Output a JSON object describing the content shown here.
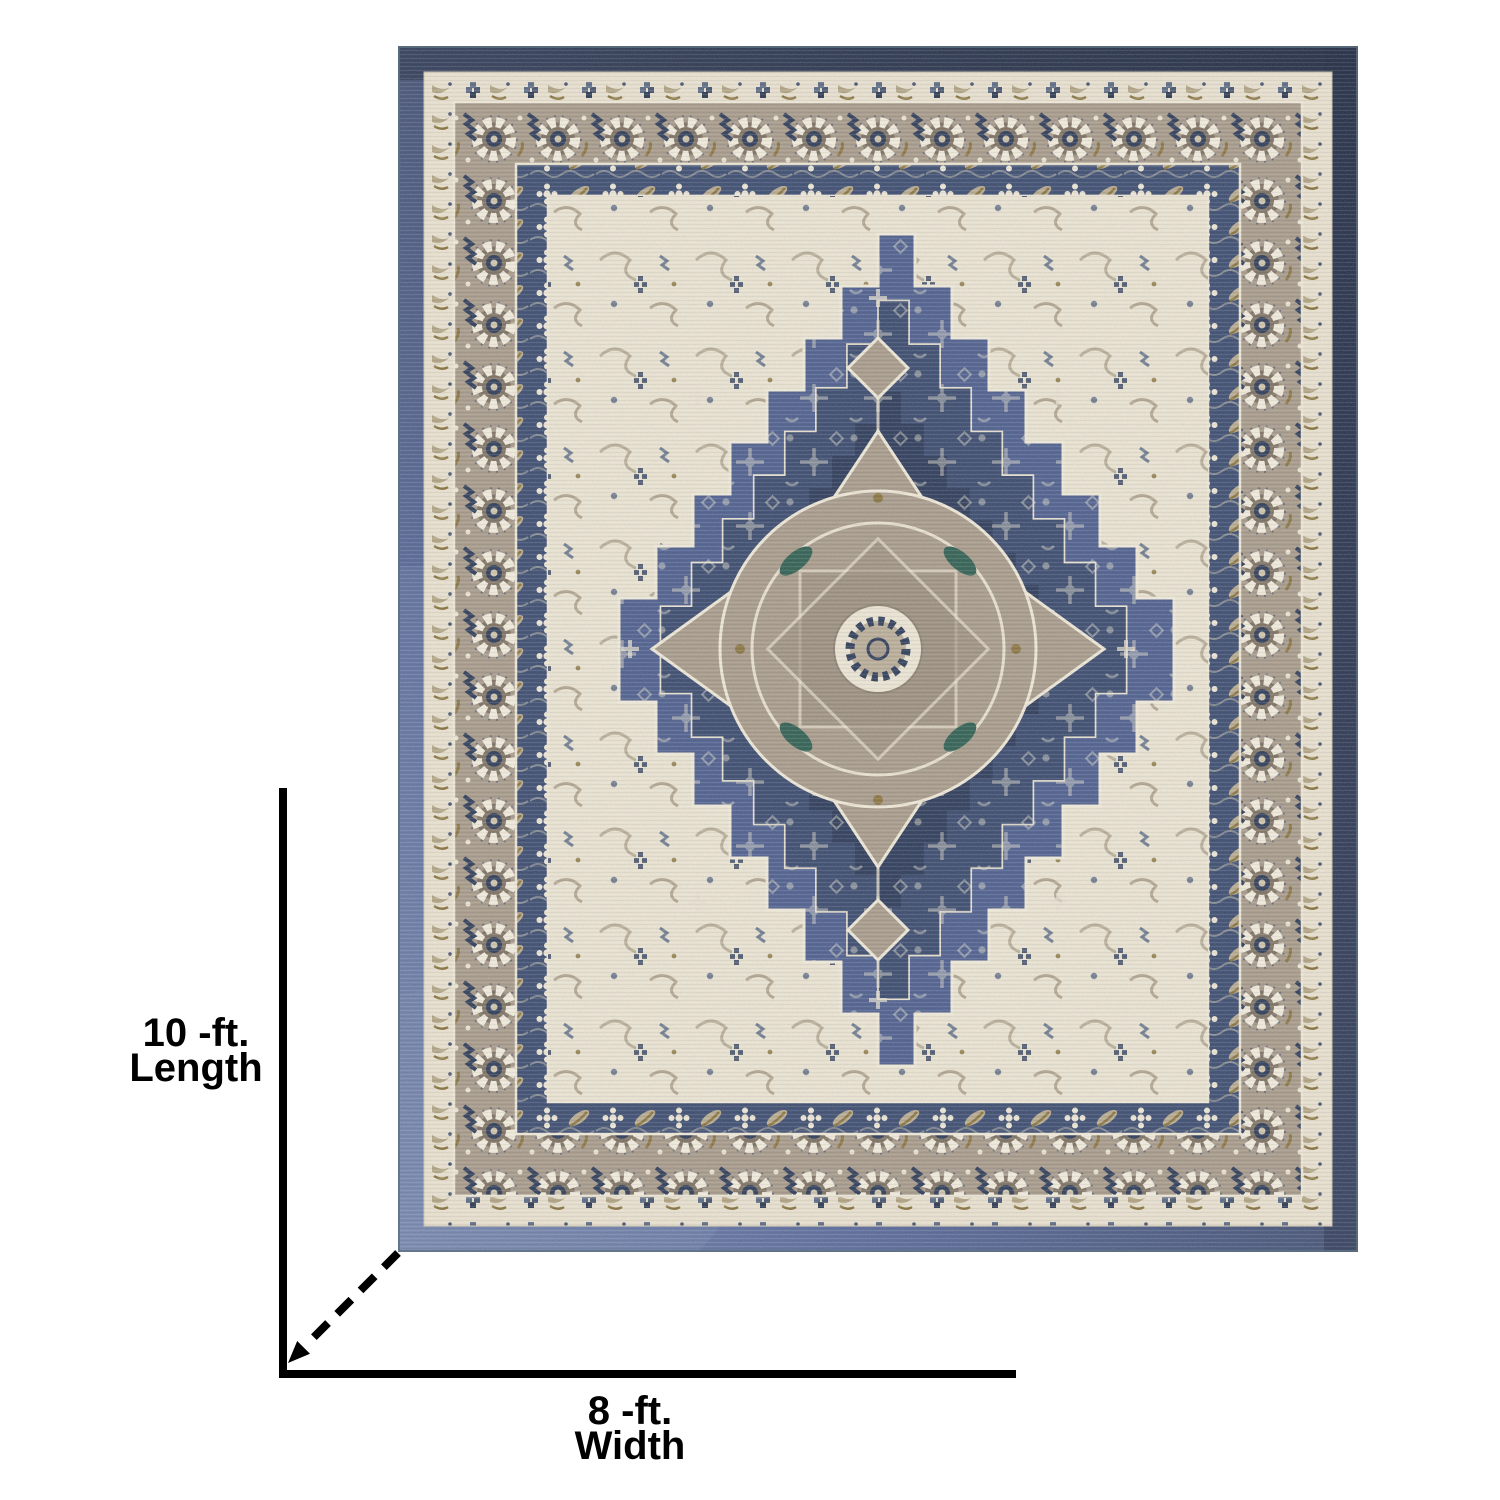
{
  "page": {
    "background_color": "#ffffff"
  },
  "diagram": {
    "subject": "vintage-medallion-area-rug",
    "length_dimension": {
      "value_line": "10 -ft.",
      "name_line": "Length"
    },
    "width_dimension": {
      "value_line": "8 -ft.",
      "name_line": "Width"
    },
    "palette": {
      "page_background": "#ffffff",
      "annotation": "#000000",
      "rug_navy_dark": "#27314a",
      "rug_denim": "#55669b",
      "rug_field_blue": "#4e5f8e",
      "rug_navy_medallion": "#2d3b5a",
      "rug_ivory": "#ebe4d2",
      "rug_taupe": "#a79a89",
      "rug_olive_gold": "#8a7540",
      "rug_teal": "#2f5f51"
    }
  }
}
